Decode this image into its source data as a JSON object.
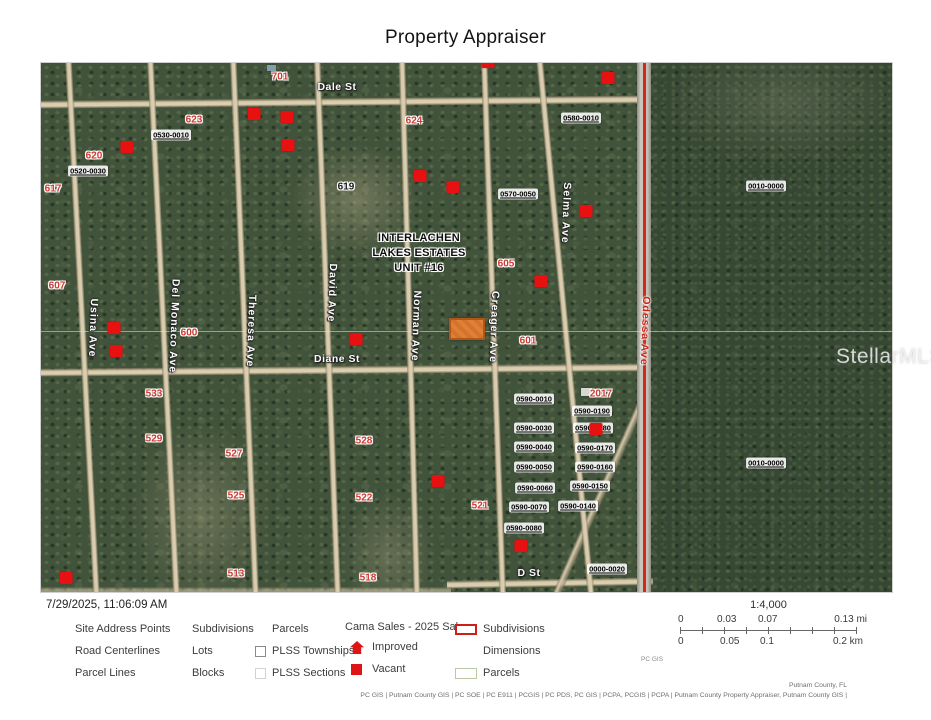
{
  "title": "Property Appraiser",
  "timestamp": "7/29/2025, 11:06:09 AM",
  "watermark": "StellarMLS",
  "map": {
    "subdivision_lines": [
      "INTERLACHEN",
      "LAKES ESTATES",
      "UNIT #16"
    ],
    "streets": [
      {
        "label": "Dale St",
        "x": 296,
        "y": 24,
        "vertical": false
      },
      {
        "label": "Diane St",
        "x": 296,
        "y": 296,
        "vertical": false
      },
      {
        "label": "D St",
        "x": 488,
        "y": 510,
        "vertical": false
      },
      {
        "label": "Usina Ave",
        "x": 52,
        "y": 265,
        "vertical": true
      },
      {
        "label": "Del Monaco Ave",
        "x": 133,
        "y": 263,
        "vertical": true
      },
      {
        "label": "Theresa Ave",
        "x": 210,
        "y": 268,
        "vertical": true
      },
      {
        "label": "David Ave",
        "x": 291,
        "y": 230,
        "vertical": true
      },
      {
        "label": "Norman Ave",
        "x": 375,
        "y": 263,
        "vertical": true
      },
      {
        "label": "Creager Ave",
        "x": 453,
        "y": 264,
        "vertical": true
      },
      {
        "label": "Selma Ave",
        "x": 525,
        "y": 150,
        "vertical": true
      },
      {
        "label": "Odessa Ave",
        "x": 604,
        "y": 268,
        "vertical": true,
        "red": true
      }
    ],
    "parcels": [
      {
        "text": "0530-0010",
        "x": 130,
        "y": 72
      },
      {
        "text": "0520-0030",
        "x": 47,
        "y": 108
      },
      {
        "text": "0580-0010",
        "x": 540,
        "y": 55
      },
      {
        "text": "0570-0050",
        "x": 477,
        "y": 131
      },
      {
        "text": "0590-0010",
        "x": 493,
        "y": 336
      },
      {
        "text": "0590-0190",
        "x": 551,
        "y": 348
      },
      {
        "text": "0590-0030",
        "x": 493,
        "y": 365
      },
      {
        "text": "0590-0180",
        "x": 552,
        "y": 365
      },
      {
        "text": "0590-0040",
        "x": 493,
        "y": 384
      },
      {
        "text": "0590-0170",
        "x": 554,
        "y": 385
      },
      {
        "text": "0590-0050",
        "x": 493,
        "y": 404
      },
      {
        "text": "0590-0160",
        "x": 554,
        "y": 404
      },
      {
        "text": "0590-0060",
        "x": 494,
        "y": 425
      },
      {
        "text": "0590-0150",
        "x": 549,
        "y": 423
      },
      {
        "text": "0590-0070",
        "x": 488,
        "y": 444
      },
      {
        "text": "0590-0140",
        "x": 537,
        "y": 443
      },
      {
        "text": "0590-0080",
        "x": 483,
        "y": 465
      },
      {
        "text": "0000-0020",
        "x": 566,
        "y": 506
      },
      {
        "text": "0010-0000",
        "x": 725,
        "y": 123
      },
      {
        "text": "0010-0000",
        "x": 725,
        "y": 400
      }
    ],
    "addresses": [
      {
        "text": "701",
        "x": 239,
        "y": 14
      },
      {
        "text": "623",
        "x": 153,
        "y": 57
      },
      {
        "text": "624",
        "x": 373,
        "y": 58
      },
      {
        "text": "620",
        "x": 53,
        "y": 93
      },
      {
        "text": "617",
        "x": 12,
        "y": 126
      },
      {
        "text": "619",
        "x": 305,
        "y": 124,
        "black": true
      },
      {
        "text": "607",
        "x": 16,
        "y": 223
      },
      {
        "text": "600",
        "x": 148,
        "y": 270
      },
      {
        "text": "605",
        "x": 465,
        "y": 201
      },
      {
        "text": "601",
        "x": 487,
        "y": 278
      },
      {
        "text": "2017",
        "x": 560,
        "y": 331
      },
      {
        "text": "533",
        "x": 113,
        "y": 331
      },
      {
        "text": "529",
        "x": 113,
        "y": 376
      },
      {
        "text": "527",
        "x": 193,
        "y": 391
      },
      {
        "text": "525",
        "x": 195,
        "y": 433
      },
      {
        "text": "513",
        "x": 195,
        "y": 511
      },
      {
        "text": "528",
        "x": 323,
        "y": 378
      },
      {
        "text": "522",
        "x": 323,
        "y": 435
      },
      {
        "text": "521",
        "x": 439,
        "y": 443
      },
      {
        "text": "518",
        "x": 327,
        "y": 515
      }
    ],
    "markers": [
      {
        "x": 447,
        "y": -1
      },
      {
        "x": 567,
        "y": 15
      },
      {
        "x": 213,
        "y": 51
      },
      {
        "x": 246,
        "y": 54
      },
      {
        "x": 86,
        "y": 84
      },
      {
        "x": 247,
        "y": 82
      },
      {
        "x": 379,
        "y": 113
      },
      {
        "x": 412,
        "y": 124
      },
      {
        "x": 545,
        "y": 148
      },
      {
        "x": 500,
        "y": 218
      },
      {
        "x": 73,
        "y": 265
      },
      {
        "x": 75,
        "y": 288
      },
      {
        "x": 315,
        "y": 276
      },
      {
        "x": 555,
        "y": 366
      },
      {
        "x": 397,
        "y": 418
      },
      {
        "x": 480,
        "y": 483
      },
      {
        "x": 25,
        "y": 515
      }
    ],
    "selected_parcel": {
      "x": 408,
      "y": 255,
      "w": 36,
      "h": 22
    }
  },
  "legend": {
    "col1": [
      "Site Address Points",
      "Road Centerlines",
      "Parcel Lines"
    ],
    "col2": [
      "Subdivisions",
      "Lots",
      "Blocks"
    ],
    "col3": {
      "parcels": "Parcels",
      "townships": "PLSS Townships",
      "sections": "PLSS Sections"
    },
    "sales": {
      "header": "Cama Sales - 2025 Sales",
      "improved": "Improved",
      "vacant": "Vacant"
    },
    "col5": {
      "subdivisions": "Subdivisions",
      "dimensions": "Dimensions",
      "parcels": "Parcels"
    }
  },
  "scale": {
    "ratio": "1:4,000",
    "mi": [
      "0",
      "0.03",
      "0.07",
      "0.13 mi"
    ],
    "km": [
      "0",
      "0.05",
      "0.1",
      "0.2 km"
    ],
    "credit": "PC GIS"
  },
  "attribution": {
    "line1": "Putnam County, FL",
    "line2": "PC GIS | Putnam County GIS | PC SOE | PC E911 | PCGIS | PC PDS, PC GIS | PCPA, PCGIS | PCPA | Putnam County Property Appraiser, Putnam County GIS |"
  }
}
